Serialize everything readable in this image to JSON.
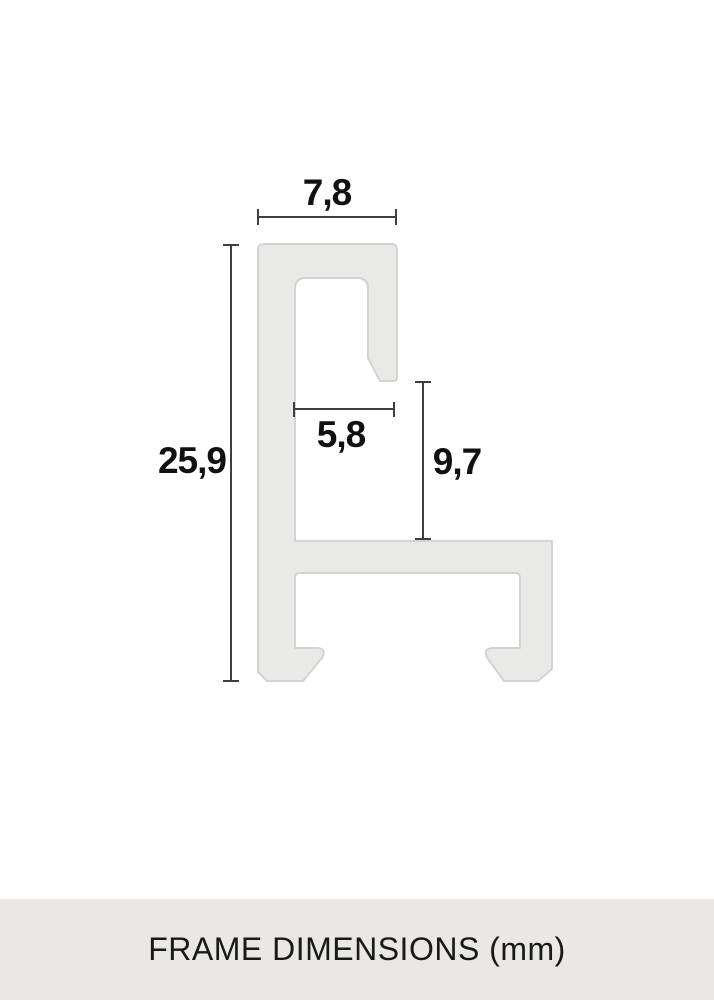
{
  "diagram": {
    "caption": "FRAME DIMENSIONS (mm)",
    "unit": "mm",
    "dimensions": {
      "top_width": "7,8",
      "total_height": "25,9",
      "inner_width": "5,8",
      "inner_height": "9,7"
    },
    "colors": {
      "background": "#ffffff",
      "profile_fill": "#e9e9e7",
      "profile_border": "#d3d3d1",
      "dimension_line": "#3f3f3f",
      "label_text": "#111111",
      "caption_background": "#e9e8e4",
      "caption_text": "#191919"
    }
  }
}
